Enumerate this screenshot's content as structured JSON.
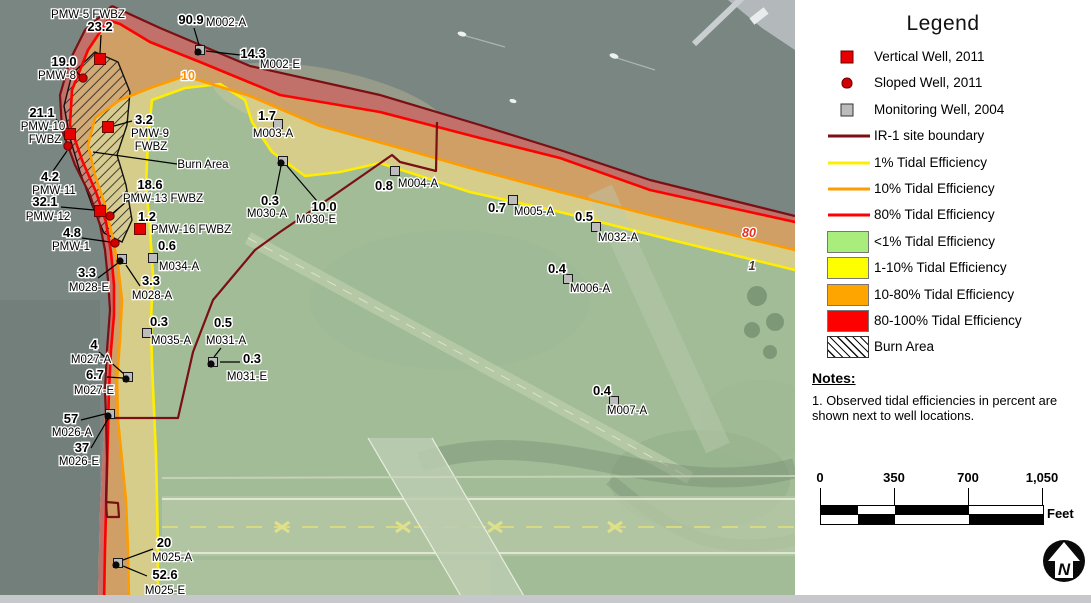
{
  "legend": {
    "title": "Legend",
    "items": [
      {
        "swatch": "red-square",
        "label": "Vertical Well, 2011"
      },
      {
        "swatch": "red-dot",
        "label": "Sloped Well, 2011"
      },
      {
        "swatch": "gray-square",
        "label": "Monitoring Well, 2004"
      },
      {
        "swatch": "line",
        "color": "#7a1014",
        "label": "IR-1 site boundary"
      },
      {
        "swatch": "line",
        "color": "#ffee00",
        "label": "1% Tidal Efficiency"
      },
      {
        "swatch": "line",
        "color": "#ff9d00",
        "label": "10% Tidal Efficiency"
      },
      {
        "swatch": "line",
        "color": "#ff0000",
        "label": "80% Tidal Efficiency"
      },
      {
        "swatch": "fill",
        "color": "#a9ee7d",
        "label": "<1% Tidal Efficiency"
      },
      {
        "swatch": "fill",
        "color": "#ffff00",
        "label": "1-10% Tidal Efficiency"
      },
      {
        "swatch": "fill",
        "color": "#ffa500",
        "label": "10-80% Tidal Efficiency"
      },
      {
        "swatch": "fill",
        "color": "#ff0000",
        "label": "80-100% Tidal Efficiency"
      },
      {
        "swatch": "hatch",
        "label": "Burn Area"
      }
    ],
    "notes_title": "Notes:",
    "notes_body": "1.  Observed tidal efficiencies in percent are shown next to well locations."
  },
  "scalebar": {
    "labels": [
      "0",
      "350",
      "700",
      "1,050"
    ],
    "tick_px": [
      0,
      74,
      148,
      222
    ],
    "seg_px": [
      37,
      37,
      74,
      74
    ],
    "row1": [
      "#000000",
      "#ffffff",
      "#000000",
      "#ffffff"
    ],
    "row2": [
      "#ffffff",
      "#000000",
      "#ffffff",
      "#000000"
    ],
    "unit": "Feet"
  },
  "north_label": "N",
  "map": {
    "colors": {
      "water": "#7a8681",
      "land": "#a2bc98",
      "zone_yellow": "#d6cd8a",
      "zone_orange": "#cf9f66",
      "zone_red": "#c1706a",
      "line_yellow": "#ffee00",
      "line_orange": "#ff9d00",
      "line_red": "#ff0000",
      "boundary": "#7a1014",
      "well_red": "#e60000",
      "well_gray": "#bcbdbc"
    },
    "contour_labels": [
      {
        "t": "10",
        "x": 188,
        "y": 80,
        "c": "#ff9000",
        "i": 0
      },
      {
        "t": "80",
        "x": 749,
        "y": 237,
        "c": "#e53122",
        "i": 1
      },
      {
        "t": "1",
        "x": 752,
        "y": 270,
        "c": "#4a3a28",
        "i": 1
      }
    ],
    "wells": [
      {
        "labels": [
          {
            "t": "PMW-5 FWBZ",
            "x": 88,
            "y": 18,
            "b": 0
          },
          {
            "t": "23.2",
            "x": 100,
            "y": 31,
            "b": 1
          }
        ],
        "marker": {
          "type": "red-square",
          "x": 100,
          "y": 59
        },
        "leaders": [
          [
            101,
            35,
            100,
            53
          ]
        ]
      },
      {
        "labels": [
          {
            "t": "90.9",
            "x": 191,
            "y": 24,
            "b": 1
          },
          {
            "t": "M002-A",
            "x": 226,
            "y": 26,
            "b": 0
          }
        ],
        "marker": {
          "type": "gray-square-dot",
          "x": 200,
          "y": 50
        },
        "leaders": [
          [
            194,
            28,
            199,
            45
          ]
        ]
      },
      {
        "labels": [
          {
            "t": "14.3",
            "x": 253,
            "y": 58,
            "b": 1
          },
          {
            "t": "M002-E",
            "x": 280,
            "y": 68,
            "b": 0
          }
        ],
        "leaders": [
          [
            240,
            55,
            206,
            51
          ]
        ]
      },
      {
        "labels": [
          {
            "t": "19.0",
            "x": 64,
            "y": 66,
            "b": 1
          },
          {
            "t": "PMW-8",
            "x": 57,
            "y": 79,
            "b": 0
          }
        ],
        "marker": {
          "type": "red-dot",
          "x": 83,
          "y": 78
        },
        "leaders": [
          [
            73,
            69,
            80,
            75
          ]
        ]
      },
      {
        "labels": [
          {
            "t": "21.1",
            "x": 42,
            "y": 117,
            "b": 1
          },
          {
            "t": "PMW-10",
            "x": 43,
            "y": 130,
            "b": 0
          },
          {
            "t": "FWBZ",
            "x": 45,
            "y": 143,
            "b": 0
          }
        ],
        "marker": {
          "type": "red-square",
          "x": 70,
          "y": 134
        },
        "leaders": [
          [
            56,
            119,
            66,
            130
          ]
        ]
      },
      {
        "labels": [
          {
            "t": "3.2",
            "x": 144,
            "y": 124,
            "b": 1
          },
          {
            "t": "PMW-9",
            "x": 150,
            "y": 137,
            "b": 0
          },
          {
            "t": "FWBZ",
            "x": 151,
            "y": 150,
            "b": 0
          }
        ],
        "marker": {
          "type": "red-square",
          "x": 108,
          "y": 127
        },
        "leaders": [
          [
            132,
            121,
            114,
            126
          ]
        ]
      },
      {
        "labels": [
          {
            "t": "4.2",
            "x": 50,
            "y": 181,
            "b": 1
          },
          {
            "t": "PMW-11",
            "x": 54,
            "y": 194,
            "b": 0
          }
        ],
        "marker": {
          "type": "red-dot",
          "x": 68,
          "y": 146
        },
        "leaders": [
          [
            53,
            171,
            67,
            151
          ]
        ]
      },
      {
        "labels": [
          {
            "t": "18.6",
            "x": 150,
            "y": 189,
            "b": 1
          },
          {
            "t": "PMW-13 FWBZ",
            "x": 163,
            "y": 202,
            "b": 0
          }
        ],
        "marker": {
          "type": "red-dot",
          "x": 110,
          "y": 216
        },
        "leaders": [
          [
            138,
            192,
            113,
            213
          ]
        ]
      },
      {
        "labels": [
          {
            "t": "32.1",
            "x": 45,
            "y": 206,
            "b": 1
          },
          {
            "t": "PMW-12",
            "x": 48,
            "y": 220,
            "b": 0
          }
        ],
        "marker": {
          "type": "red-square",
          "x": 100,
          "y": 211
        },
        "leaders": [
          [
            61,
            207,
            94,
            210
          ]
        ]
      },
      {
        "labels": [
          {
            "t": "4.8",
            "x": 72,
            "y": 237,
            "b": 1
          },
          {
            "t": "PMW-1",
            "x": 71,
            "y": 250,
            "b": 0
          }
        ],
        "marker": {
          "type": "red-dot",
          "x": 115,
          "y": 243
        },
        "leaders": [
          [
            82,
            238,
            110,
            242
          ]
        ]
      },
      {
        "labels": [
          {
            "t": "1.2",
            "x": 147,
            "y": 221,
            "b": 1
          },
          {
            "t": "PMW-16 FWBZ",
            "x": 191,
            "y": 233,
            "b": 0
          }
        ],
        "marker": {
          "type": "red-square",
          "x": 140,
          "y": 229
        }
      },
      {
        "labels": [
          {
            "t": "0.6",
            "x": 167,
            "y": 250,
            "b": 1
          },
          {
            "t": "M034-A",
            "x": 179,
            "y": 270,
            "b": 0
          }
        ],
        "marker": {
          "type": "gray-square",
          "x": 153,
          "y": 258
        }
      },
      {
        "labels": [
          {
            "t": "3.3",
            "x": 87,
            "y": 277,
            "b": 1
          },
          {
            "t": "M028-E",
            "x": 89,
            "y": 291,
            "b": 0
          }
        ],
        "marker": {
          "type": "gray-square-dot",
          "x": 122,
          "y": 259
        },
        "leaders": [
          [
            98,
            278,
            118,
            263
          ]
        ]
      },
      {
        "labels": [
          {
            "t": "3.3",
            "x": 151,
            "y": 285,
            "b": 1
          },
          {
            "t": "M028-A",
            "x": 152,
            "y": 299,
            "b": 0
          }
        ],
        "leaders": [
          [
            140,
            286,
            126,
            265
          ]
        ]
      },
      {
        "labels": [
          {
            "t": "0.3",
            "x": 159,
            "y": 326,
            "b": 1
          },
          {
            "t": "M035-A",
            "x": 171,
            "y": 344,
            "b": 0
          }
        ],
        "marker": {
          "type": "gray-square",
          "x": 147,
          "y": 333
        }
      },
      {
        "labels": [
          {
            "t": "0.5",
            "x": 223,
            "y": 327,
            "b": 1
          },
          {
            "t": "M031-A",
            "x": 226,
            "y": 344,
            "b": 0
          }
        ],
        "marker": {
          "type": "gray-square-dot",
          "x": 213,
          "y": 362
        },
        "leaders": [
          [
            221,
            348,
            214,
            357
          ]
        ]
      },
      {
        "labels": [
          {
            "t": "0.3",
            "x": 252,
            "y": 363,
            "b": 1
          },
          {
            "t": "M031-E",
            "x": 247,
            "y": 380,
            "b": 0
          }
        ],
        "leaders": [
          [
            240,
            362,
            220,
            362
          ]
        ]
      },
      {
        "labels": [
          {
            "t": "4",
            "x": 94,
            "y": 349,
            "b": 1
          },
          {
            "t": "M027-A",
            "x": 91,
            "y": 363,
            "b": 0
          }
        ],
        "marker": {
          "type": "gray-square-dot",
          "x": 128,
          "y": 377
        },
        "leaders": [
          [
            99,
            352,
            124,
            374
          ]
        ]
      },
      {
        "labels": [
          {
            "t": "6.7",
            "x": 95,
            "y": 379,
            "b": 1
          },
          {
            "t": "M027-E",
            "x": 94,
            "y": 394,
            "b": 0
          }
        ],
        "leaders": [
          [
            107,
            377,
            123,
            378
          ]
        ]
      },
      {
        "labels": [
          {
            "t": "57",
            "x": 71,
            "y": 423,
            "b": 1
          },
          {
            "t": "M026-A",
            "x": 72,
            "y": 436,
            "b": 0
          }
        ],
        "marker": {
          "type": "gray-square-dot",
          "x": 110,
          "y": 414
        },
        "leaders": [
          [
            81,
            420,
            105,
            414
          ]
        ]
      },
      {
        "labels": [
          {
            "t": "37",
            "x": 82,
            "y": 452,
            "b": 1
          },
          {
            "t": "M026-E",
            "x": 79,
            "y": 465,
            "b": 0
          }
        ],
        "leaders": [
          [
            91,
            448,
            108,
            419
          ]
        ]
      },
      {
        "labels": [
          {
            "t": "20",
            "x": 164,
            "y": 547,
            "b": 1
          },
          {
            "t": "M025-A",
            "x": 172,
            "y": 561,
            "b": 0
          }
        ],
        "marker": {
          "type": "gray-square-dot",
          "x": 118,
          "y": 563
        },
        "leaders": [
          [
            153,
            549,
            123,
            560
          ]
        ]
      },
      {
        "labels": [
          {
            "t": "52.6",
            "x": 165,
            "y": 579,
            "b": 1
          },
          {
            "t": "M025-E",
            "x": 165,
            "y": 594,
            "b": 0
          }
        ],
        "leaders": [
          [
            147,
            576,
            123,
            566
          ]
        ]
      },
      {
        "labels": [
          {
            "t": "1.7",
            "x": 267,
            "y": 120,
            "b": 1
          },
          {
            "t": "M003-A",
            "x": 273,
            "y": 137,
            "b": 0
          }
        ],
        "marker": {
          "type": "gray-square",
          "x": 278,
          "y": 124
        }
      },
      {
        "labels": [
          {
            "t": "0.3",
            "x": 270,
            "y": 205,
            "b": 1
          },
          {
            "t": "M030-A",
            "x": 267,
            "y": 217,
            "b": 0
          },
          {
            "t": "10.0",
            "x": 324,
            "y": 211,
            "b": 1
          },
          {
            "t": "M030-E",
            "x": 316,
            "y": 223,
            "b": 0
          }
        ],
        "marker": {
          "type": "gray-square-dot",
          "x": 283,
          "y": 161
        },
        "leaders": [
          [
            275,
            196,
            281,
            166
          ],
          [
            317,
            201,
            287,
            166
          ]
        ]
      },
      {
        "labels": [
          {
            "t": "0.8",
            "x": 384,
            "y": 190,
            "b": 1
          },
          {
            "t": "M004-A",
            "x": 418,
            "y": 187,
            "b": 0
          }
        ],
        "marker": {
          "type": "gray-square",
          "x": 395,
          "y": 171
        }
      },
      {
        "labels": [
          {
            "t": "0.7",
            "x": 497,
            "y": 212,
            "b": 1
          },
          {
            "t": "M005-A",
            "x": 534,
            "y": 215,
            "b": 0
          }
        ],
        "marker": {
          "type": "gray-square",
          "x": 513,
          "y": 200
        }
      },
      {
        "labels": [
          {
            "t": "0.5",
            "x": 584,
            "y": 221,
            "b": 1
          },
          {
            "t": "M032-A",
            "x": 618,
            "y": 241,
            "b": 0
          }
        ],
        "marker": {
          "type": "gray-square",
          "x": 596,
          "y": 227
        }
      },
      {
        "labels": [
          {
            "t": "0.4",
            "x": 557,
            "y": 273,
            "b": 1
          },
          {
            "t": "M006-A",
            "x": 590,
            "y": 292,
            "b": 0
          }
        ],
        "marker": {
          "type": "gray-square",
          "x": 568,
          "y": 279
        }
      },
      {
        "labels": [
          {
            "t": "0.4",
            "x": 602,
            "y": 395,
            "b": 1
          },
          {
            "t": "M007-A",
            "x": 627,
            "y": 414,
            "b": 0
          }
        ],
        "marker": {
          "type": "gray-square",
          "x": 614,
          "y": 401
        }
      },
      {
        "labels": [
          {
            "t": "Burn Area",
            "x": 203,
            "y": 168,
            "b": 0
          }
        ],
        "leaders": [
          [
            177,
            164,
            93,
            152
          ]
        ]
      }
    ]
  }
}
